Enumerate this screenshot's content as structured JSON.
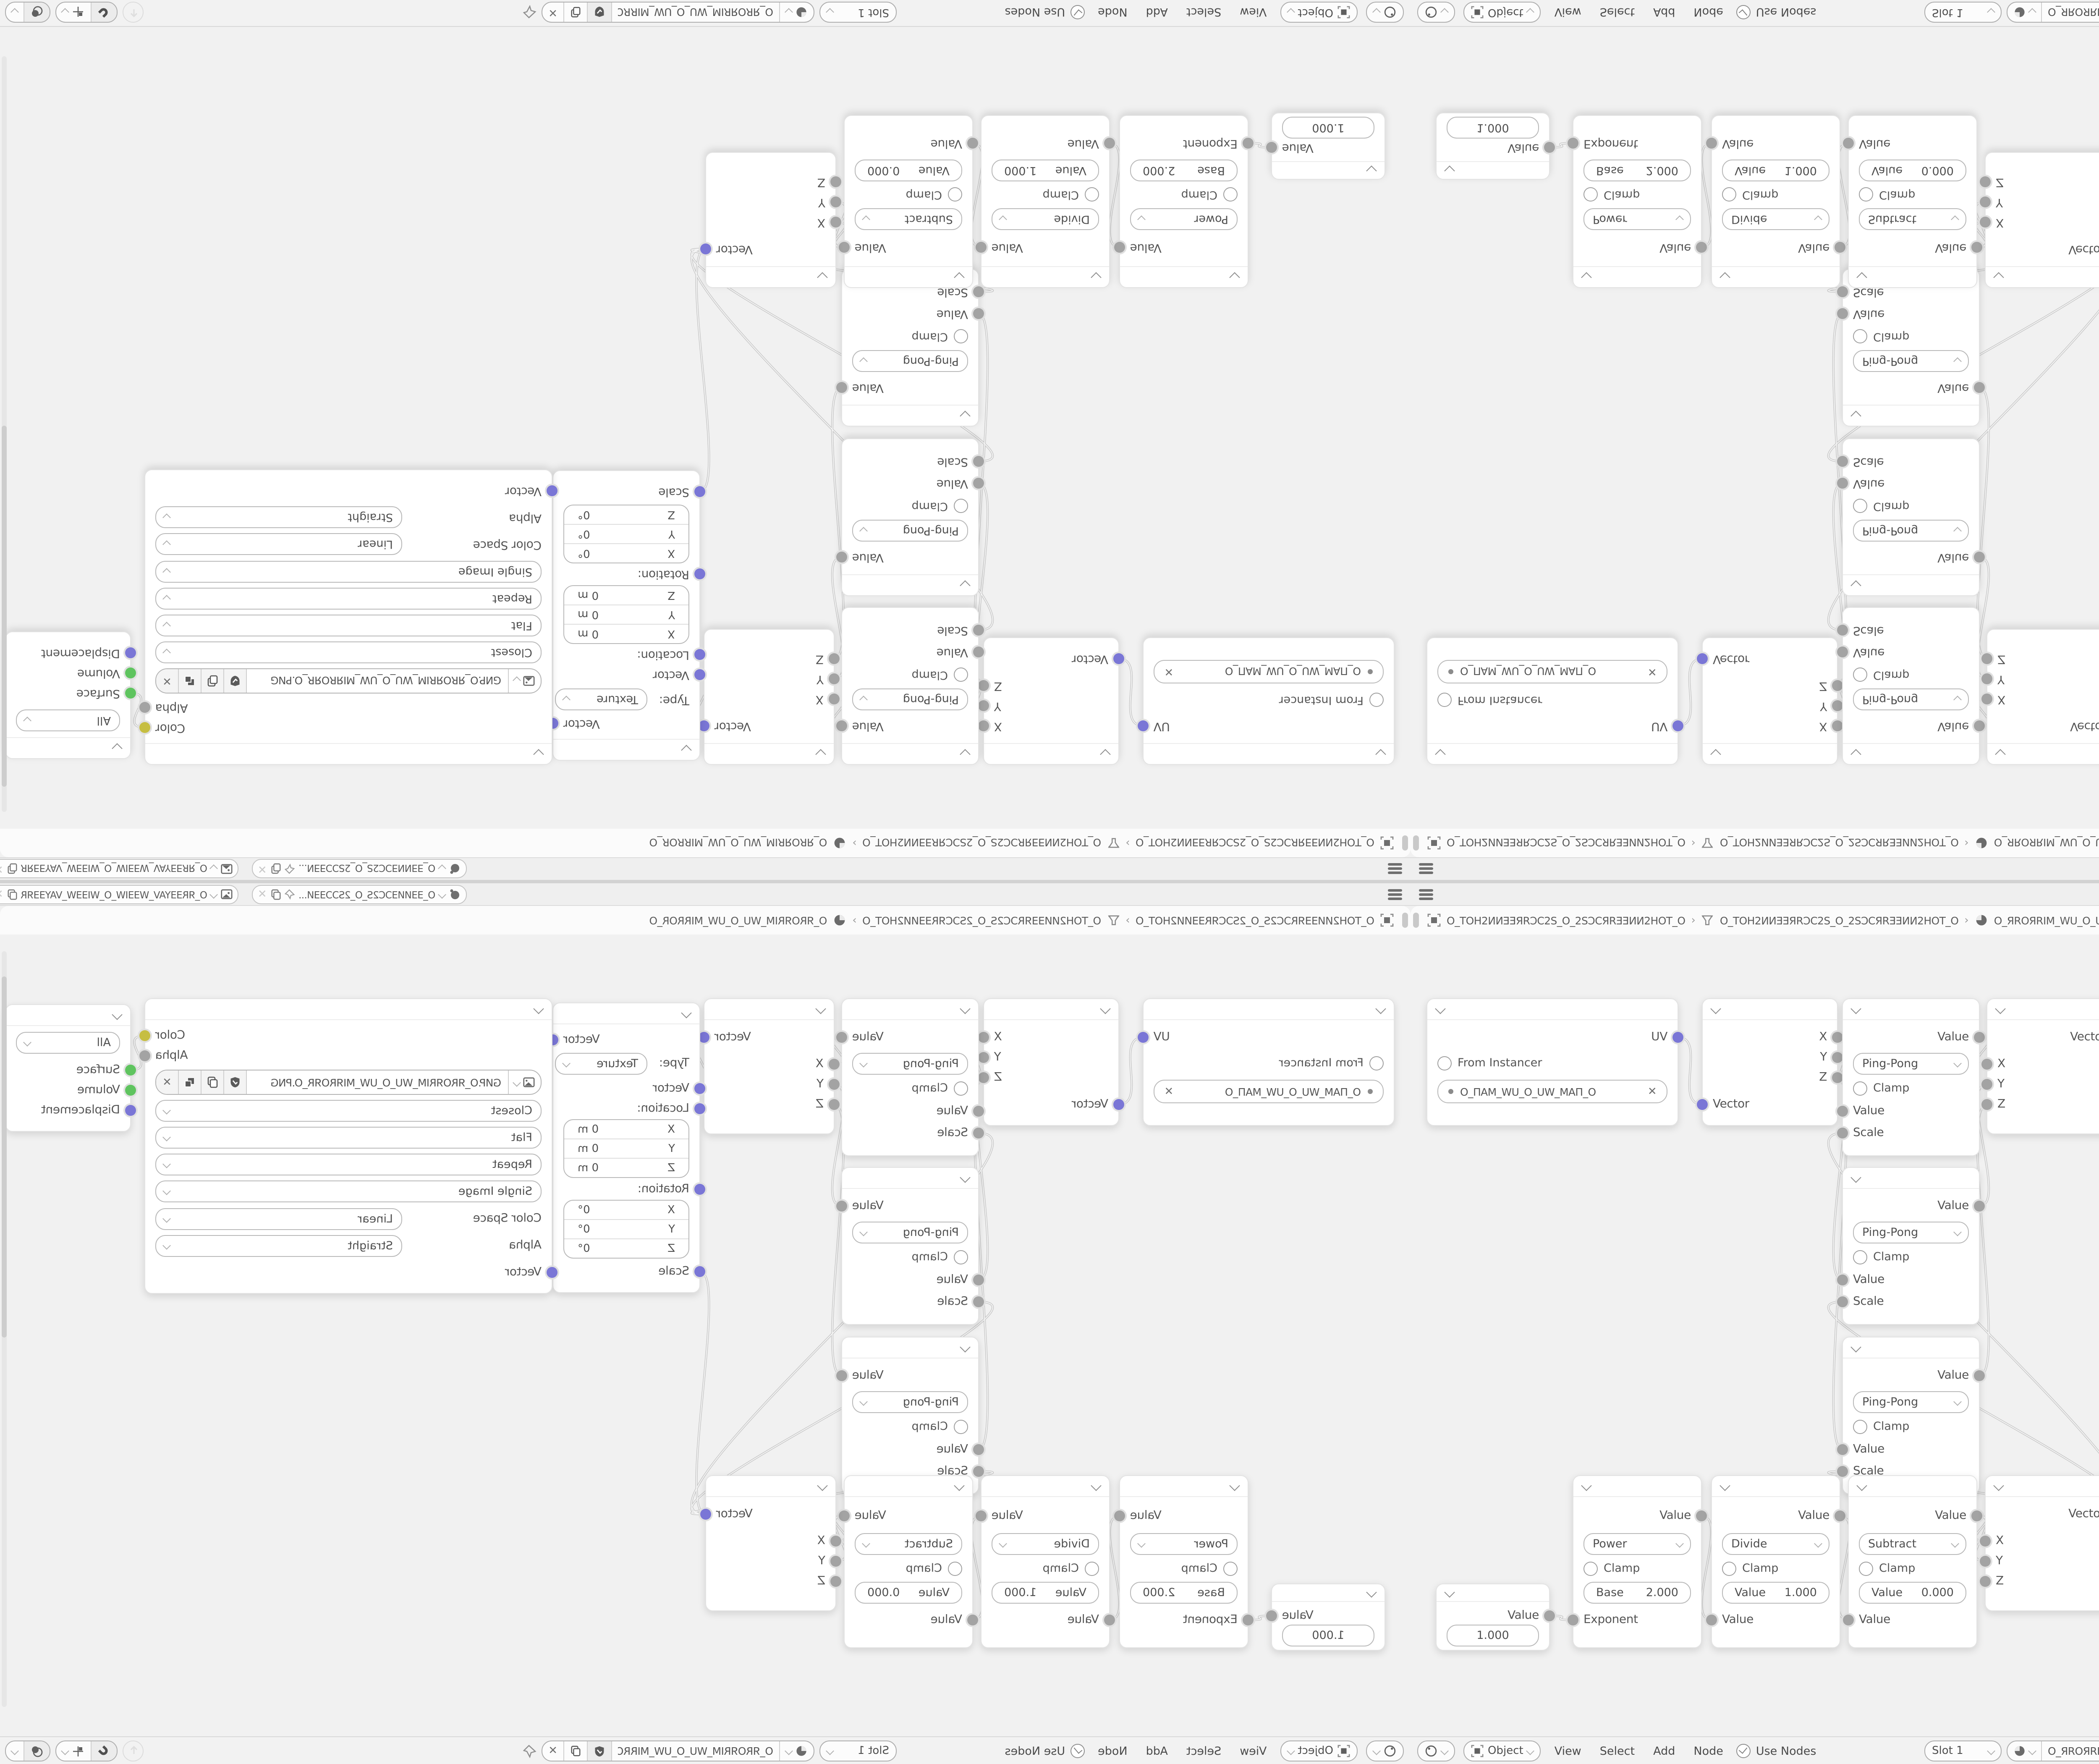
{
  "strips": {
    "row_a": {
      "widget_scene_text": "O_ƎƎИͶƎƆC2S_O_2SƆƆƎƎͶ...",
      "widget_layer_text": "O_ЯRƎƎYAV_WƎƎIW_O_WIƎƎW_VAYƎƎЯR_O"
    },
    "row_b": {
      "scene": "O_TOH2ͶИƎƎЯRƆC2S_O_2SƆCЯRƎƎИͶ2HOT_O",
      "view_layer": "O_TOH2ͶИƎƎЯRƆC2S_O_2SƆCЯRƎƎИͶ2HOT_O",
      "material": "O_ЯROЯRIM_WU_O_UW_MIRROR_O",
      "separator": "›"
    }
  },
  "editor_bar": {
    "mode": "Object",
    "menus": [
      "View",
      "Select",
      "Add",
      "Node"
    ],
    "use_nodes": "Use Nodes",
    "slot": "Slot 1",
    "material_name": "O_ЯROЯRIM_WU_O_UW_MIRROR_O",
    "close": "✕"
  },
  "nodes": {
    "uvmap": {
      "uv": "UV",
      "from_instancer": "From Instancer",
      "map_name": "O_ПAM_WU_O_UW_MAП_O",
      "close": "✕"
    },
    "separate": {
      "x": "X",
      "y": "Y",
      "z": "Z",
      "vector": "Vector"
    },
    "pingpong": {
      "value": "Value",
      "op": "Ping-Pong",
      "clamp": "Clamp",
      "in_value": "Value",
      "in_scale": "Scale"
    },
    "combine": {
      "vector": "Vector",
      "x": "X",
      "y": "Y",
      "z": "Z"
    },
    "mapping": {
      "vector_out": "Vector",
      "type_label": "Type:",
      "type_value": "Texture",
      "vector_in": "Vector",
      "location": "Location:",
      "rotation": "Rotation:",
      "scale": "Scale",
      "axis_x": "X",
      "axis_y": "Y",
      "axis_z": "Z",
      "loc_val": "0 m",
      "rot_val": "0°"
    },
    "image_texture": {
      "color": "Color",
      "alpha": "Alpha",
      "filename": "GИP.O_ЯROЯRIM_WU_O_UW_MIЯROЯR_O.PNG",
      "interpolation": "Closest",
      "projection": "Flat",
      "extension": "Repeat",
      "source": "Single Image",
      "color_space_label": "Color Space",
      "color_space": "Linear",
      "alpha_label": "Alpha",
      "alpha_mode": "Straight",
      "vector": "Vector",
      "close": "✕"
    },
    "output": {
      "target": "All",
      "surface": "Surface",
      "volume": "Volume",
      "displacement": "Displacement"
    },
    "value_node": {
      "value": "Value",
      "field": "1.000"
    },
    "power": {
      "value": "Value",
      "op": "Power",
      "clamp": "Clamp",
      "field_label": "Base",
      "field_value": "2.000",
      "input": "Exponent"
    },
    "divide": {
      "value": "Value",
      "op": "Divide",
      "clamp": "Clamp",
      "field_label": "Value",
      "field_value": "1.000",
      "input": "Value"
    },
    "subtract": {
      "value": "Value",
      "op": "Subtract",
      "clamp": "Clamp",
      "field_label": "Value",
      "field_value": "0.000",
      "input": "Value"
    }
  },
  "links": [
    [
      "uv-out",
      "sep-in"
    ],
    [
      "sep-x",
      "pp1-val"
    ],
    [
      "sep-y",
      "pp2-val"
    ],
    [
      "sep-z",
      "pp3-val"
    ],
    [
      "pp1-out",
      "ct-x"
    ],
    [
      "pp2-out",
      "ct-y"
    ],
    [
      "pp3-out",
      "ct-z"
    ],
    [
      "ct-out",
      "map-vec"
    ],
    [
      "map-out",
      "tex-vec"
    ],
    [
      "tex-color",
      "out-surface"
    ],
    [
      "val-out",
      "pow-exp"
    ],
    [
      "pow-out",
      "div-val"
    ],
    [
      "div-out",
      "sub-val"
    ],
    [
      "sub-out",
      "cb-x"
    ],
    [
      "sub-out",
      "cb-y"
    ],
    [
      "cb-out",
      "map-scale"
    ],
    [
      "cb-out",
      "pp1-scale"
    ],
    [
      "cb-out",
      "pp2-scale"
    ],
    [
      "cb-out",
      "pp3-scale"
    ]
  ],
  "colors": {
    "socket_value": "#a3a3a3",
    "socket_vector": "#7a76d6",
    "socket_shader": "#5fc45f",
    "socket_color": "#c6be42",
    "noodle": "#c6c6c6",
    "canvas": "#f1f1f1"
  }
}
